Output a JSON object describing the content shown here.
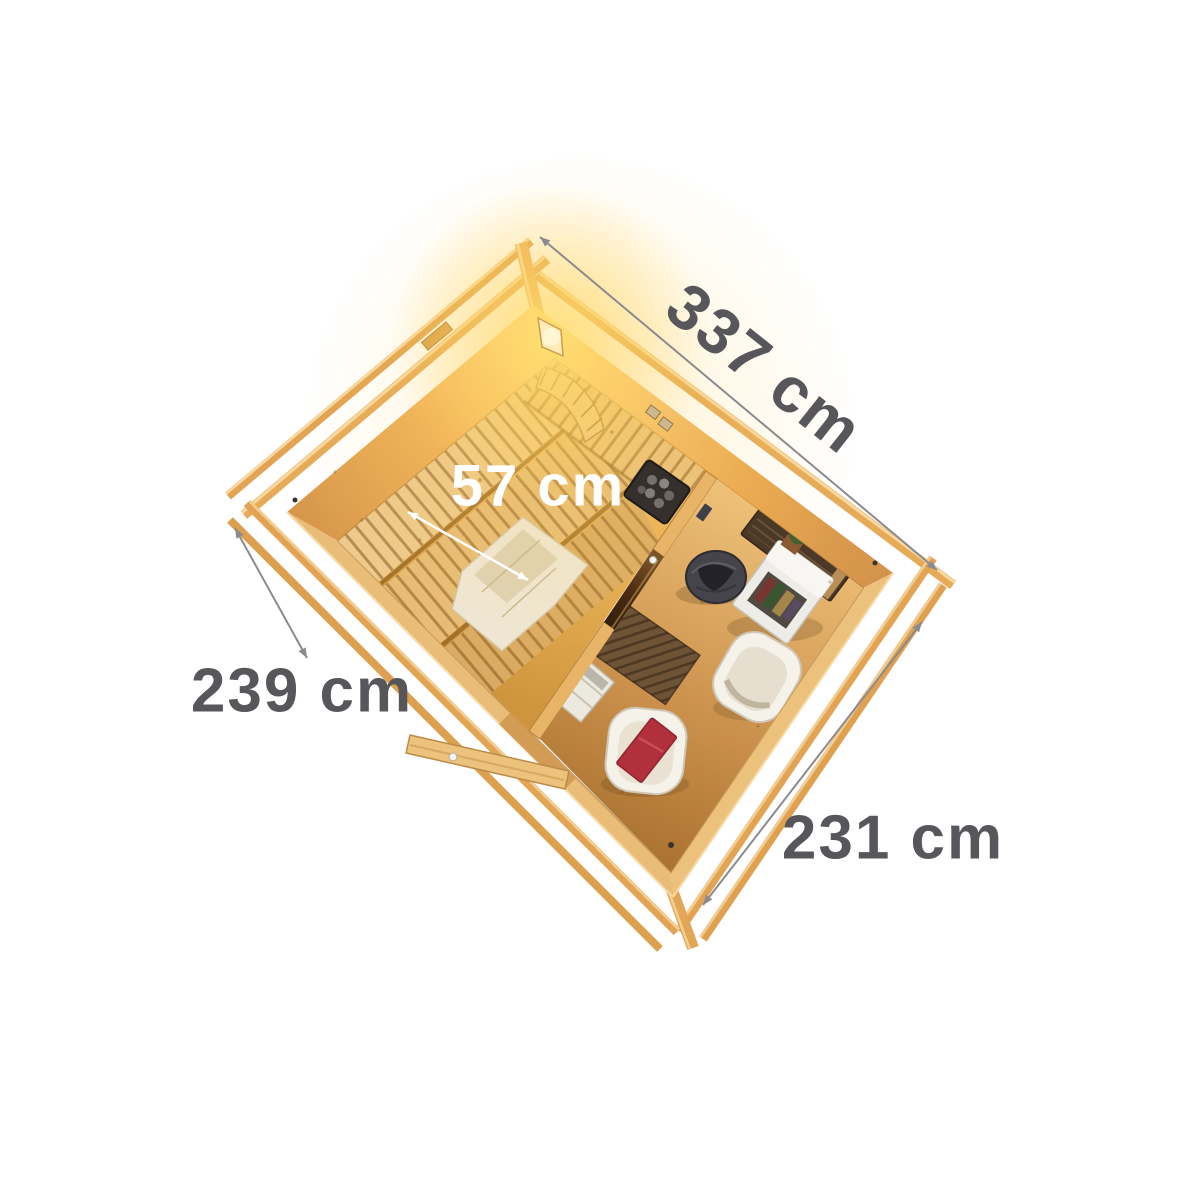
{
  "product_view": {
    "description": "Bird's-eye 3D cutaway illustration of a two-room wooden sauna cabin: sauna room with tiered slatted benches, curved headrest, heater and glowing corner light; anteroom with two lounge chairs, red cushion, basket, cabinet with plant and wall shelf; open entrance door; dimension lines on white background",
    "background": "#ffffff"
  },
  "measurements": {
    "top_edge": "337 cm",
    "left_edge": "239 cm",
    "bottom_edge": "231 cm",
    "bench_depth": "57 cm"
  },
  "colors": {
    "dimension_text": "#57575b",
    "dimension_line": "#8b8b8f",
    "bench_label": "#ffffff",
    "wood_light": "#f3c577",
    "wood_mid": "#e2a656",
    "wood_dark": "#b97f3e",
    "glow_yellow": "#ffd45e",
    "cushion_red": "#b2303c",
    "heater_dark": "#35302c"
  }
}
